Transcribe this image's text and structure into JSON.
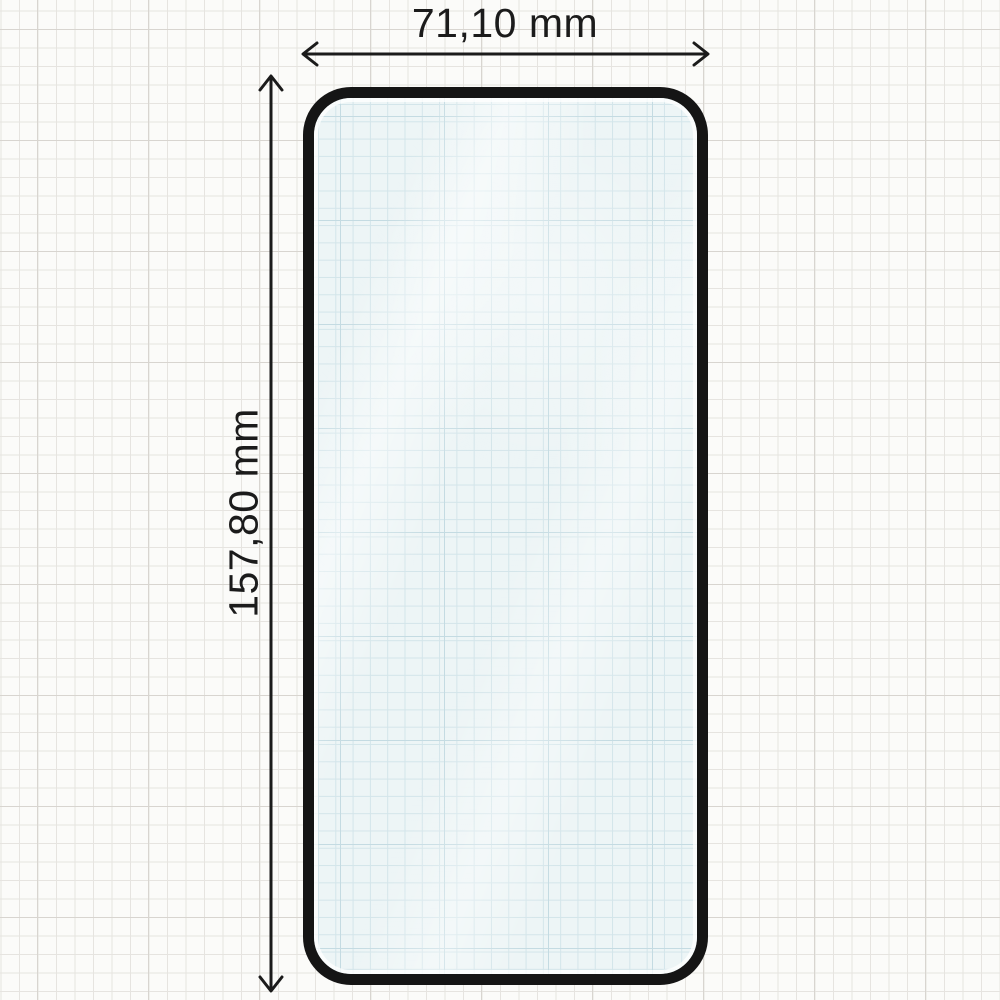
{
  "diagram": {
    "type": "dimension-drawing",
    "subject": "tempered-glass-screen-protector",
    "width_label": "71,10 mm",
    "height_label": "157,80 mm"
  },
  "icons": {
    "width_arrow": "horizontal-double-arrow",
    "height_arrow": "vertical-double-arrow"
  },
  "colors": {
    "paper": "#fbfbf9",
    "grid_minor": "#e6e4e0",
    "grid_major": "#d8d5d0",
    "frame": "#151515",
    "glass_fill": "#edf5f6",
    "glass_grid": "#d3e5ea",
    "glass_grid_major": "#c4dbe2",
    "ink": "#1b1b1b"
  }
}
